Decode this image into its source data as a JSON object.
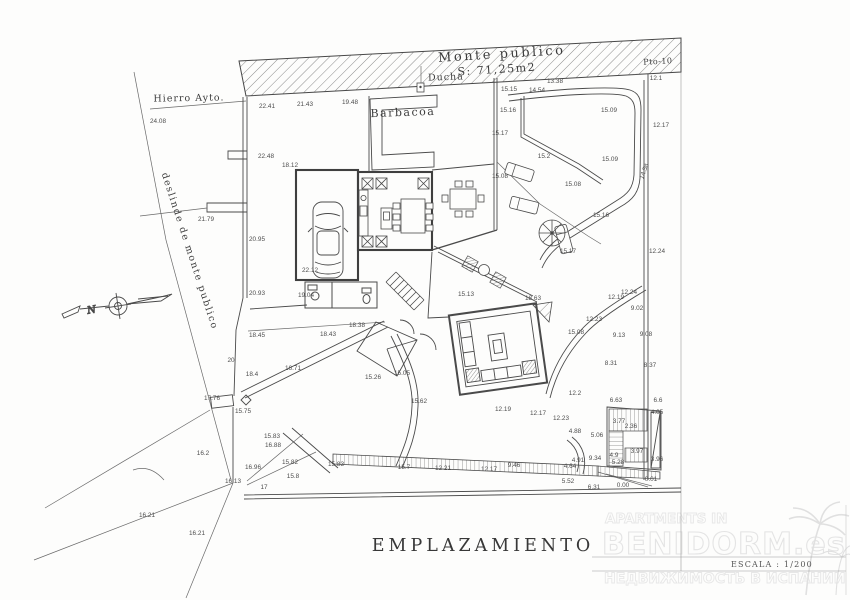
{
  "page": {
    "background": "#fdfdfc",
    "line_color": "#4a4a4a",
    "text_color": "#4d4d4d",
    "watermark_color": "#e9e9e9"
  },
  "title_block": {
    "title": "EMPLAZAMIENTO",
    "scale_label": "ESCALA : 1/200"
  },
  "watermark": {
    "line1": "APARTMENTS IN",
    "line2": "BENIDORM.es",
    "line3": "НЕДВИЖИМОСТЬ В ИСПАНИИ",
    "palm_icon": "palm-tree-icon"
  },
  "site_labels": {
    "monte_publico": "Monte publico",
    "monte_publico_area": "S: 71,25m2",
    "ducha": "Ducha",
    "pto": "Pto-10",
    "barbacoa": "Barbacoa",
    "hierro": "Hierro Ayto.",
    "deslinde": "deslinde de monte publico",
    "north": "N"
  },
  "annotations": [
    {
      "t": "24.08",
      "x": 158,
      "y": 123
    },
    {
      "t": "22.41",
      "x": 267,
      "y": 108
    },
    {
      "t": "21.43",
      "x": 305,
      "y": 106
    },
    {
      "t": "19.48",
      "x": 350,
      "y": 104
    },
    {
      "t": "22.48",
      "x": 266,
      "y": 158
    },
    {
      "t": "18.12",
      "x": 290,
      "y": 167
    },
    {
      "t": "21.79",
      "x": 206,
      "y": 221
    },
    {
      "t": "20.95",
      "x": 257,
      "y": 241
    },
    {
      "t": "20.93",
      "x": 257,
      "y": 295
    },
    {
      "t": "22.12",
      "x": 310,
      "y": 272
    },
    {
      "t": "19.04",
      "x": 306,
      "y": 297
    },
    {
      "t": "20",
      "x": 231,
      "y": 362
    },
    {
      "t": "15.15",
      "x": 509,
      "y": 91
    },
    {
      "t": "14.54",
      "x": 537,
      "y": 92
    },
    {
      "t": "13.38",
      "x": 555,
      "y": 83
    },
    {
      "t": "12.1",
      "x": 656,
      "y": 80
    },
    {
      "t": "15.16",
      "x": 508,
      "y": 112
    },
    {
      "t": "15.09",
      "x": 609,
      "y": 112
    },
    {
      "t": "12.17",
      "x": 661,
      "y": 127
    },
    {
      "t": "15.17",
      "x": 500,
      "y": 135
    },
    {
      "t": "15.2",
      "x": 544,
      "y": 158
    },
    {
      "t": "15.09",
      "x": 610,
      "y": 161
    },
    {
      "t": "14.58",
      "x": 646,
      "y": 172,
      "r": -70
    },
    {
      "t": "15.08",
      "x": 500,
      "y": 178
    },
    {
      "t": "15.08",
      "x": 573,
      "y": 186
    },
    {
      "t": "15.16",
      "x": 601,
      "y": 217
    },
    {
      "t": "15.17",
      "x": 568,
      "y": 253
    },
    {
      "t": "12.24",
      "x": 657,
      "y": 253
    },
    {
      "t": "15.13",
      "x": 466,
      "y": 296
    },
    {
      "t": "18.63",
      "x": 533,
      "y": 300
    },
    {
      "t": "15.08",
      "x": 576,
      "y": 334
    },
    {
      "t": "12.23",
      "x": 594,
      "y": 321
    },
    {
      "t": "12.19",
      "x": 616,
      "y": 299
    },
    {
      "t": "12.24",
      "x": 629,
      "y": 294
    },
    {
      "t": "9.02",
      "x": 637,
      "y": 310
    },
    {
      "t": "9.13",
      "x": 619,
      "y": 337
    },
    {
      "t": "9.08",
      "x": 646,
      "y": 336
    },
    {
      "t": "8.31",
      "x": 611,
      "y": 365
    },
    {
      "t": "8.37",
      "x": 650,
      "y": 367
    },
    {
      "t": "12.2",
      "x": 575,
      "y": 395
    },
    {
      "t": "6.63",
      "x": 616,
      "y": 402
    },
    {
      "t": "6.6",
      "x": 658,
      "y": 402
    },
    {
      "t": "4.05",
      "x": 657,
      "y": 414
    },
    {
      "t": "3.77",
      "x": 619,
      "y": 423
    },
    {
      "t": "2.36",
      "x": 631,
      "y": 428
    },
    {
      "t": "4.9",
      "x": 614,
      "y": 457
    },
    {
      "t": "3.97",
      "x": 637,
      "y": 453
    },
    {
      "t": "9.34",
      "x": 595,
      "y": 460
    },
    {
      "t": "5.28",
      "x": 618,
      "y": 464
    },
    {
      "t": "3.96",
      "x": 657,
      "y": 461
    },
    {
      "t": "0.00",
      "x": 623,
      "y": 487
    },
    {
      "t": "0.01",
      "x": 651,
      "y": 481
    },
    {
      "t": "4.88",
      "x": 575,
      "y": 433
    },
    {
      "t": "5.06",
      "x": 597,
      "y": 437
    },
    {
      "t": "4.91",
      "x": 578,
      "y": 462
    },
    {
      "t": "4.64",
      "x": 570,
      "y": 468
    },
    {
      "t": "5.52",
      "x": 568,
      "y": 483
    },
    {
      "t": "6.31",
      "x": 594,
      "y": 489
    },
    {
      "t": "15.62",
      "x": 419,
      "y": 403
    },
    {
      "t": "12.19",
      "x": 503,
      "y": 411
    },
    {
      "t": "12.17",
      "x": 538,
      "y": 415
    },
    {
      "t": "12.23",
      "x": 561,
      "y": 420
    },
    {
      "t": "15.83",
      "x": 336,
      "y": 466
    },
    {
      "t": "15.7",
      "x": 404,
      "y": 469
    },
    {
      "t": "12.21",
      "x": 443,
      "y": 470
    },
    {
      "t": "12.17",
      "x": 489,
      "y": 471
    },
    {
      "t": "9.46",
      "x": 514,
      "y": 467
    },
    {
      "t": "18.45",
      "x": 257,
      "y": 337
    },
    {
      "t": "18.43",
      "x": 328,
      "y": 336
    },
    {
      "t": "18.38",
      "x": 357,
      "y": 327
    },
    {
      "t": "18.4",
      "x": 252,
      "y": 376
    },
    {
      "t": "16.71",
      "x": 293,
      "y": 370
    },
    {
      "t": "15.26",
      "x": 373,
      "y": 379
    },
    {
      "t": "15.05",
      "x": 402,
      "y": 375
    },
    {
      "t": "17.76",
      "x": 212,
      "y": 400
    },
    {
      "t": "15.75",
      "x": 243,
      "y": 413
    },
    {
      "t": "15.83",
      "x": 272,
      "y": 438
    },
    {
      "t": "16.88",
      "x": 273,
      "y": 447
    },
    {
      "t": "16.2",
      "x": 203,
      "y": 455
    },
    {
      "t": "15.82",
      "x": 290,
      "y": 464
    },
    {
      "t": "16.96",
      "x": 253,
      "y": 469
    },
    {
      "t": "16.13",
      "x": 233,
      "y": 483
    },
    {
      "t": "15.8",
      "x": 293,
      "y": 478
    },
    {
      "t": "17",
      "x": 264,
      "y": 489
    },
    {
      "t": "16.21",
      "x": 147,
      "y": 517
    },
    {
      "t": "16.21",
      "x": 197,
      "y": 535
    }
  ]
}
